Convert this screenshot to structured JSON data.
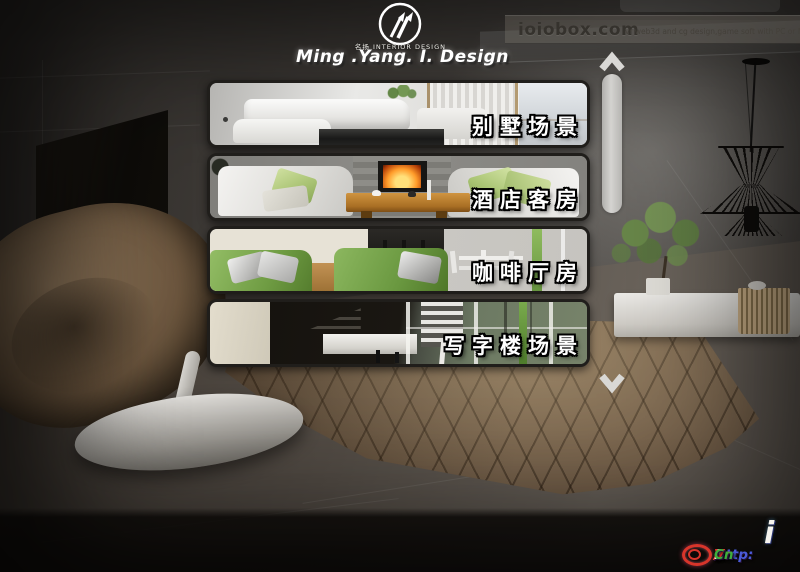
{
  "logo": {
    "sub_brand": "名扬 INTERIOR DESIGN",
    "brand": "Ming .Yang. I. Design"
  },
  "topbar": {
    "site": "ioiobox.com",
    "tagline": "vr web3d and cg design,game soft with PC or MAC"
  },
  "menu": {
    "items": [
      {
        "label": "别墅场景"
      },
      {
        "label": "酒店客房"
      },
      {
        "label": "咖啡厅房"
      },
      {
        "label": "写字楼场景"
      }
    ]
  },
  "watermark": {
    "i_mark": "i",
    "segments": [
      {
        "text": "Http:",
        "color": "#4a5bd8"
      },
      {
        "text": "//",
        "color": "#e5332a"
      },
      {
        "text": "1",
        "color": "#f5f2ec"
      },
      {
        "text": "Vr",
        "color": "#e5332a"
      },
      {
        "text": ".",
        "color": "#f5f2ec"
      },
      {
        "text": "Cn",
        "color": "#3fae3c"
      }
    ]
  },
  "colors": {
    "menu_label_text": "#ffffff",
    "menu_label_outline": "#000000",
    "panel_border": "#201e1b",
    "scroll_thumb": "#c9c8c5",
    "watermark_ring": "#d8352b"
  }
}
